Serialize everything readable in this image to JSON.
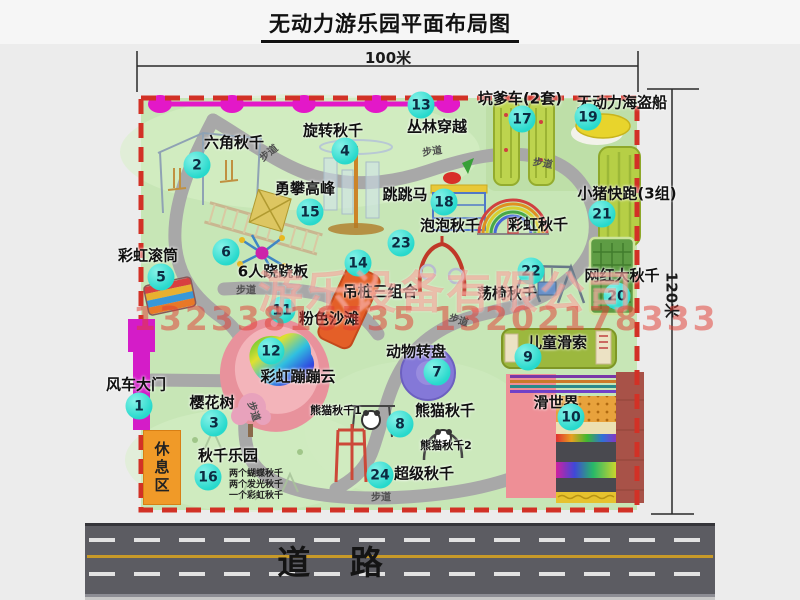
{
  "title": "无动力游乐园平面布局图",
  "dimensions": {
    "width": "100米",
    "height": "120米"
  },
  "road_label": "道 路",
  "rest_area_label": "休息区",
  "walkway_label": "步道",
  "watermark": {
    "company": "游乐设备有限公司",
    "phone": "13233816535 13202178333"
  },
  "attractions": [
    {
      "num": "1",
      "label": "风车大门"
    },
    {
      "num": "2",
      "label": "六角秋千"
    },
    {
      "num": "3",
      "label": "樱花树"
    },
    {
      "num": "4",
      "label": "旋转秋千"
    },
    {
      "num": "5",
      "label": "彩虹滚筒"
    },
    {
      "num": "6",
      "label": "6人跷跷板"
    },
    {
      "num": "7",
      "label": "动物转盘"
    },
    {
      "num": "8",
      "label": "熊猫秋千"
    },
    {
      "num": "9",
      "label": "儿童滑索"
    },
    {
      "num": "10",
      "label": "滑世界"
    },
    {
      "num": "11",
      "label": "粉色沙滩"
    },
    {
      "num": "12",
      "label": "彩虹蹦蹦云"
    },
    {
      "num": "13",
      "label": "丛林穿越"
    },
    {
      "num": "14",
      "label": "吊桩三组合"
    },
    {
      "num": "15",
      "label": "勇攀高峰"
    },
    {
      "num": "16",
      "label": "秋千乐园"
    },
    {
      "num": "17",
      "label": "坑爹车(2套)"
    },
    {
      "num": "18",
      "label": "跳跳马"
    },
    {
      "num": "19",
      "label": "无动力海盗船"
    },
    {
      "num": "20",
      "label": "网红大秋千"
    },
    {
      "num": "21",
      "label": "小猪快跑(3组)"
    },
    {
      "num": "22",
      "label": "荡椅秋千"
    },
    {
      "num": "23",
      "label": "泡泡秋千"
    },
    {
      "num": "24",
      "label": "超级秋千"
    }
  ],
  "unnumbered_labels": {
    "rainbow_swing": "彩虹秋千",
    "panda_swing_1": "熊猫秋千1",
    "panda_swing_2": "熊猫秋千2"
  },
  "swing_park_notes": [
    "两个蝴蝶秋千",
    "两个发光秋千",
    "一个彩虹秋千"
  ],
  "colors": {
    "badge": "#27d9cc",
    "map_bg": "#c7e6b6",
    "border": "#d23126",
    "path": "#a8a8a8",
    "chain": "#e318c8",
    "gate": "#d41cc8",
    "rest_area": "#f09a28",
    "road": "#5c5c62"
  }
}
